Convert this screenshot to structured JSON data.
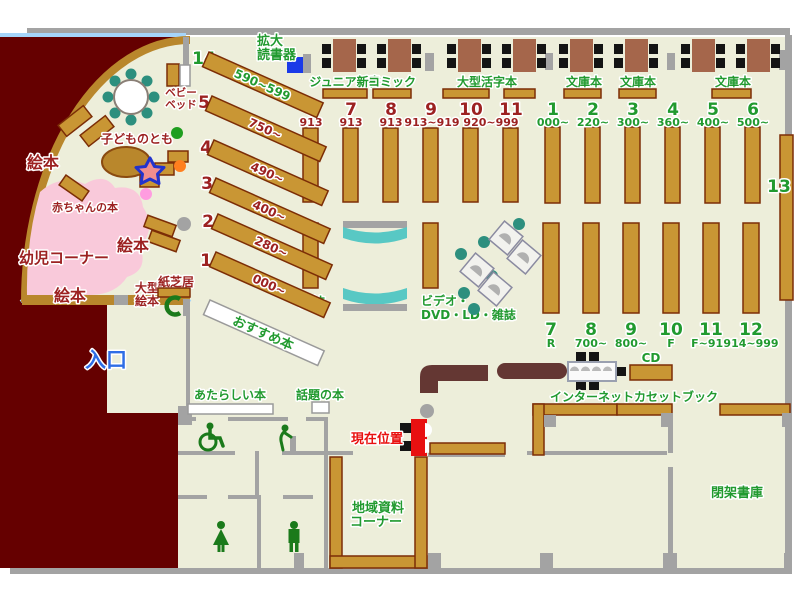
{
  "palette": {
    "floor": "#edeeda",
    "outer_wall": "#650000",
    "inner_wall": "#a3a3a3",
    "shelf_tan": "#c99634",
    "shelf_border": "#7c2d06",
    "kids_wall_tan": "#b9872c",
    "table_brown": "#a5664b",
    "counter_maroon": "#643733",
    "sofa_teal": "#58c8c4",
    "chair_teal": "#2d8f7e",
    "kids_pink": "#f9c9da",
    "window_blue": "#a5d5fa",
    "label_green": "#219a2f",
    "label_dark_red": "#9c2121",
    "label_red": "#e81010",
    "label_blue": "#2e6de6",
    "magnifier_blue": "#1a3ae8"
  },
  "icons": {
    "wheelchair": "wheelchair-icon",
    "drinking_fountain": "fountain-icon",
    "toilet_woman": "toilet-woman-icon",
    "toilet_man": "toilet-man-icon",
    "public_phone": "phone-icon",
    "play_star": "star-icon",
    "you_are_here": "you-are-here-marker"
  },
  "labels": {
    "entrance": "入口",
    "current_location": "現在位置",
    "magnifier_l1": "拡大",
    "magnifier_l2": "読書器",
    "junior": "ジュニア新書",
    "comic": "コミック",
    "large_print": "大型活字本",
    "bunko1": "文庫本",
    "bunko2": "文庫本",
    "bunko3": "文庫本",
    "magazines": "雑誌",
    "av_l1": "ビデオ・",
    "av_l2": "DVD・LD・雑誌",
    "cd": "CD",
    "internet": "インターネット",
    "cassette": "カセットブック",
    "new_books": "あたらしい本",
    "topic_books": "話題の本",
    "local_l1": "地域資料",
    "local_l2": "コーナー",
    "closed_stacks": "閉架書庫",
    "recommended": "おすすめ本",
    "kids_corner": "幼児コーナー",
    "baby_books": "赤ちゃんの本",
    "kodomo": "子どものとも",
    "ehon1": "絵本",
    "ehon2": "絵本",
    "ehon3": "絵本",
    "oogata_l1": "大型",
    "oogata_l2": "絵本",
    "kamishibai": "紙芝居",
    "babybed_l1": "ベビー",
    "babybed_l2": "ベッド",
    "shelf_13": "13"
  },
  "diagonal_shelves": [
    {
      "num": "14",
      "range": "590~599",
      "color": "green"
    },
    {
      "num": "5",
      "range": "750~",
      "color": "dark_red"
    },
    {
      "num": "4",
      "range": "490~",
      "color": "dark_red"
    },
    {
      "num": "3",
      "range": "400~",
      "color": "dark_red"
    },
    {
      "num": "2",
      "range": "280~",
      "color": "dark_red"
    },
    {
      "num": "1",
      "range": "000~",
      "color": "dark_red"
    }
  ],
  "stacks_913": [
    {
      "num": "6",
      "range": "913"
    },
    {
      "num": "7",
      "range": "913"
    },
    {
      "num": "8",
      "range": "913"
    },
    {
      "num": "9",
      "range": "913~919"
    },
    {
      "num": "10",
      "range": "920~999"
    },
    {
      "num": "11",
      "range": ""
    }
  ],
  "stacks_nonfiction": [
    {
      "num": "1",
      "range": "000~"
    },
    {
      "num": "2",
      "range": "220~"
    },
    {
      "num": "3",
      "range": "300~"
    },
    {
      "num": "4",
      "range": "360~"
    },
    {
      "num": "5",
      "range": "400~"
    },
    {
      "num": "6",
      "range": "500~"
    }
  ],
  "stacks_bottom": [
    {
      "num": "7",
      "range": "R"
    },
    {
      "num": "8",
      "range": "700~"
    },
    {
      "num": "9",
      "range": "800~"
    },
    {
      "num": "10",
      "range": "F"
    },
    {
      "num": "11",
      "range": "F~914"
    },
    {
      "num": "12",
      "range": "914~999"
    }
  ]
}
